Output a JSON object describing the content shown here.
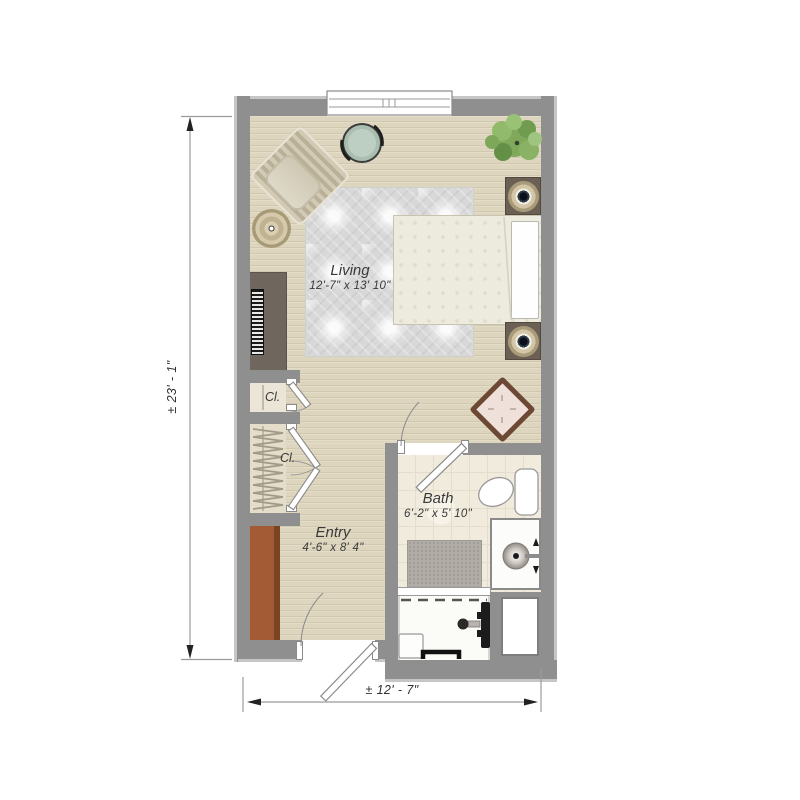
{
  "type": "floor-plan",
  "plan_title": "Studio apartment floor plan",
  "rooms": {
    "living": {
      "name": "Living",
      "dims": "12'-7\" x 13' 10\""
    },
    "entry": {
      "name": "Entry",
      "dims": "4'-6\" x 8' 4\""
    },
    "bath": {
      "name": "Bath",
      "dims": "6'-2\" x 5' 10\""
    },
    "closet_upper": {
      "name": "Cl."
    },
    "closet_lower": {
      "name": "Cl."
    }
  },
  "dimensions": {
    "overall_height": "± 23' - 1\"",
    "overall_width": "± 12' - 7\""
  },
  "furniture": [
    "armchair",
    "round-table",
    "side-table",
    "plant",
    "bed",
    "pillow",
    "nightstand",
    "table-lamp",
    "dresser",
    "accent-table",
    "entry-cabinet",
    "area-rug",
    "hanging-rod"
  ],
  "fixtures": [
    "window",
    "door",
    "toilet",
    "sink-vanity",
    "bath-mat",
    "shower",
    "shower-seat",
    "grab-bar",
    "shower-controls",
    "utility-closet"
  ],
  "colors": {
    "wall": "#8f8f8f",
    "wall_edge": "#c6c6c6",
    "floor": "#ddd5bd",
    "tile": "#f0ebdd",
    "rug": "#d8d8d8",
    "bed": "#edeade",
    "cabinet_brown": "#a25b35",
    "dresser_taupe": "#6f675d",
    "table_sage": "#b7c8ba",
    "plant_green": "#7ca757",
    "label_text": "#3a3a3a"
  }
}
